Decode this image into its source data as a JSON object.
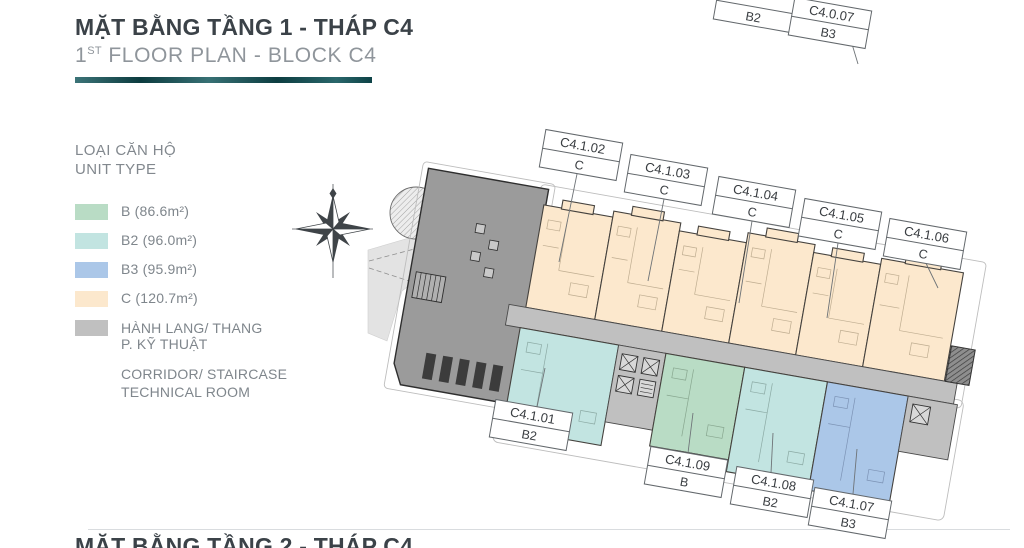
{
  "header": {
    "title": "MẶT BẰNG TẦNG 1 - THÁP C4",
    "subtitle_num": "1",
    "subtitle_sup": "ST",
    "subtitle_rest": " FLOOR PLAN - BLOCK C4",
    "accent_color": "#11555a"
  },
  "legend": {
    "heading_line1": "LOẠI CĂN HỘ",
    "heading_line2": "UNIT TYPE",
    "items": [
      {
        "code": "B",
        "label": "B (86.6m²)",
        "color": "#b9dcc5"
      },
      {
        "code": "B2",
        "label": "B2 (96.0m²)",
        "color": "#c2e4e1"
      },
      {
        "code": "B3",
        "label": "B3 (95.9m²)",
        "color": "#abc7e8"
      },
      {
        "code": "C",
        "label": "C (120.7m²)",
        "color": "#fce8cd"
      },
      {
        "code": "CORRIDOR",
        "label_line1": "HÀNH LANG/ THANG",
        "label_line2": "P. KỸ THUẬT",
        "sublabel_line1": "CORRIDOR/ STAIRCASE",
        "sublabel_line2": "TECHNICAL ROOM",
        "color": "#c0c0c0"
      }
    ]
  },
  "plan": {
    "lobby_color": "#9b9b9b",
    "wall_color": "#45423e",
    "units": [
      {
        "id": "C4.1.01",
        "type": "B2"
      },
      {
        "id": "C4.1.02",
        "type": "C"
      },
      {
        "id": "C4.1.03",
        "type": "C"
      },
      {
        "id": "C4.1.04",
        "type": "C"
      },
      {
        "id": "C4.1.05",
        "type": "C"
      },
      {
        "id": "C4.1.06",
        "type": "C"
      },
      {
        "id": "C4.1.07",
        "type": "B3"
      },
      {
        "id": "C4.1.08",
        "type": "B2"
      },
      {
        "id": "C4.1.09",
        "type": "B"
      }
    ],
    "cut_labels": [
      {
        "id": "",
        "type": "B2"
      },
      {
        "id": "C4.0.07",
        "type": "B3"
      }
    ]
  },
  "footer": {
    "next_section_title": "MẶT BẰNG TẦNG 2 - THÁP C4"
  }
}
